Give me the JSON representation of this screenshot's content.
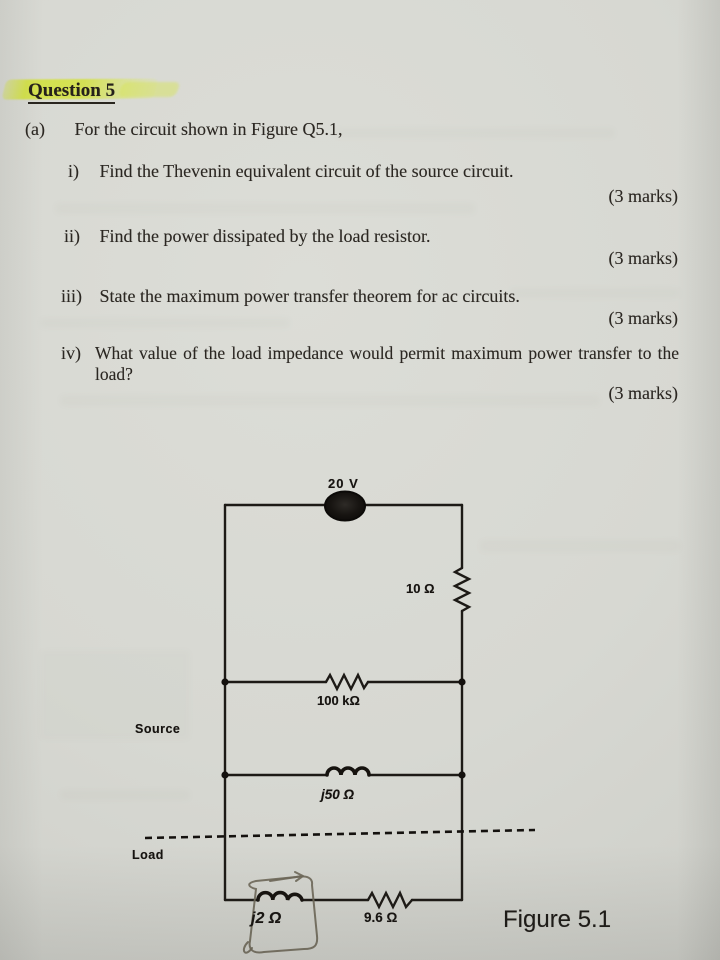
{
  "header": {
    "title": "Question 5"
  },
  "question": {
    "part_label": "(a)",
    "part_intro": "For the circuit shown in Figure Q5.1,",
    "items": [
      {
        "num": "i)",
        "text": "Find the Thevenin equivalent circuit of the source circuit.",
        "marks": "(3 marks)"
      },
      {
        "num": "ii)",
        "text": "Find the power dissipated by the load resistor.",
        "marks": "(3 marks)"
      },
      {
        "num": "iii)",
        "text": "State the maximum power transfer theorem for ac circuits.",
        "marks": "(3 marks)"
      },
      {
        "num": "iv)",
        "text": "What value of the load impedance would permit maximum power transfer to the load?",
        "marks": "(3 marks)"
      }
    ]
  },
  "figure": {
    "caption": "Figure 5.1",
    "labels": {
      "source_voltage": "20 V",
      "resistor_top": "10 Ω",
      "resistor_mid": "100 kΩ",
      "inductor_mid": "j50 Ω",
      "inductor_load": "j2 Ω",
      "resistor_load": "9.6 Ω",
      "region_source": "Source",
      "region_load": "Load"
    }
  },
  "colors": {
    "highlighter": "#d3e23e",
    "paper": "#d7d8d2",
    "ink": "#1d1a16",
    "pencil": "#6e6859"
  }
}
